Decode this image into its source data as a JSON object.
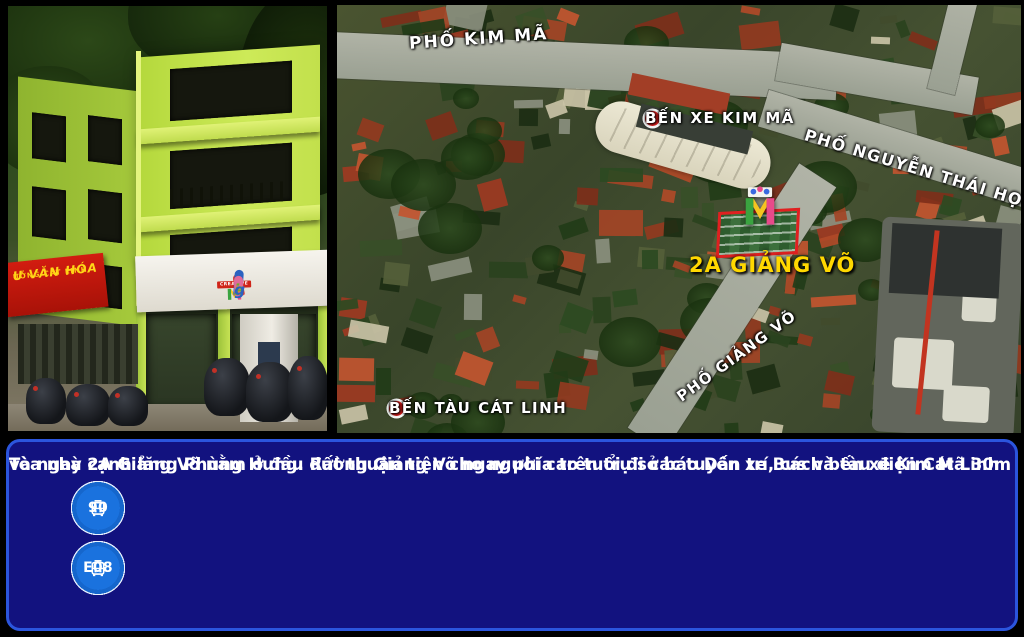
{
  "photo": {
    "alt": "Corner photo of the lime-green 2A Giang Vo building",
    "red_sign": {
      "line1": "Ư VĂN HÓA",
      "line2": "ƯỜNG CÁT LINH"
    },
    "signboard": {
      "creative_label": "CREATIVE",
      "zigzag_label": "zigzag"
    }
  },
  "map": {
    "labels": {
      "kim_ma_street": "PHỐ KIM MÃ",
      "kim_ma_station": "BẾN XE KIM MÃ",
      "nguyen_thai_hoc_street": "PHỐ NGUYỄN THÁI HỌC",
      "address": "2A GIẢNG VÕ",
      "giang_vo_street": "PHỐ GIẢNG VÕ",
      "cat_linh_station": "BẾN TÀU CÁT LINH"
    }
  },
  "info": {
    "line1": "Tòa nhà 2A Giảng Võ nằm ở đầu đường Giảng Võ ngay phía trên trụ sở báo Dân trí, cách bến xe Kim Mã 30m",
    "line2": "và ngay cạnh lăng Phùng Hưng. Rất thuận tiện cho người cao tuổi đi các tuyến xe Bus và tàu điện Cát Linh",
    "bus_rows": [
      [
        "BRT",
        "18",
        "22A",
        "23",
        "25",
        "32",
        "34",
        "38",
        "50",
        "90"
      ],
      [
        "99",
        "107",
        "142",
        "143",
        "144",
        "145",
        "146",
        "159",
        "E02",
        "E07",
        "E08"
      ]
    ]
  },
  "colors": {
    "panel_bg": "#12127f",
    "panel_border": "#2b55dd",
    "badge_blue": "#1566cc",
    "address_yellow": "#ffd800",
    "marker_red": "#e01e1e",
    "building_lime": "#c6e254"
  }
}
